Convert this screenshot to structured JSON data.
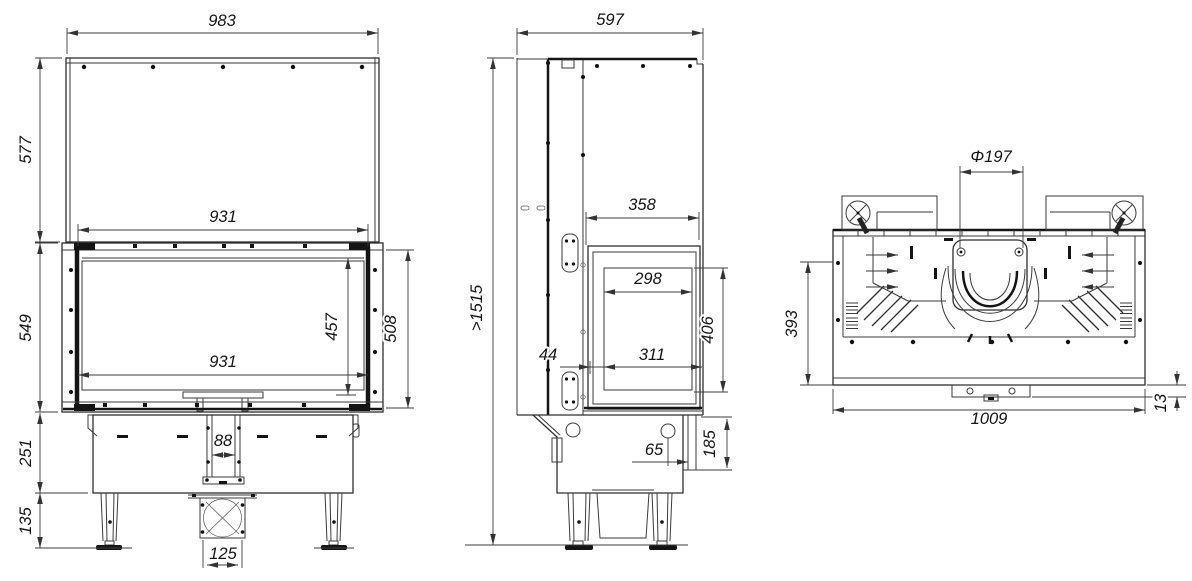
{
  "drawing": {
    "type": "fireplace-insert-technical-drawing",
    "views": {
      "front": {
        "dims": {
          "w_total": "983",
          "h_panel": "577",
          "w_top_inner": "931",
          "h_firebox": "549",
          "h_glass": "457",
          "h_frame": "508",
          "w_glass": "931",
          "h_base": "251",
          "w_channel": "88",
          "h_legs": "135",
          "w_intake": "125"
        }
      },
      "side": {
        "dims": {
          "depth": "597",
          "h_min": ">1515",
          "w_rear": "358",
          "w_glass": "298",
          "h_door": "406",
          "gap_front": "44",
          "w_opening": "311",
          "off_rear": "65",
          "h_rear": "185"
        }
      },
      "top": {
        "dims": {
          "d_flue": "Φ197",
          "depth_body": "393",
          "w_body": "1009",
          "off_bracket": "13"
        }
      }
    },
    "colors": {
      "ink": "#3a3a3a",
      "dark": "#141414",
      "background": "#ffffff"
    }
  }
}
